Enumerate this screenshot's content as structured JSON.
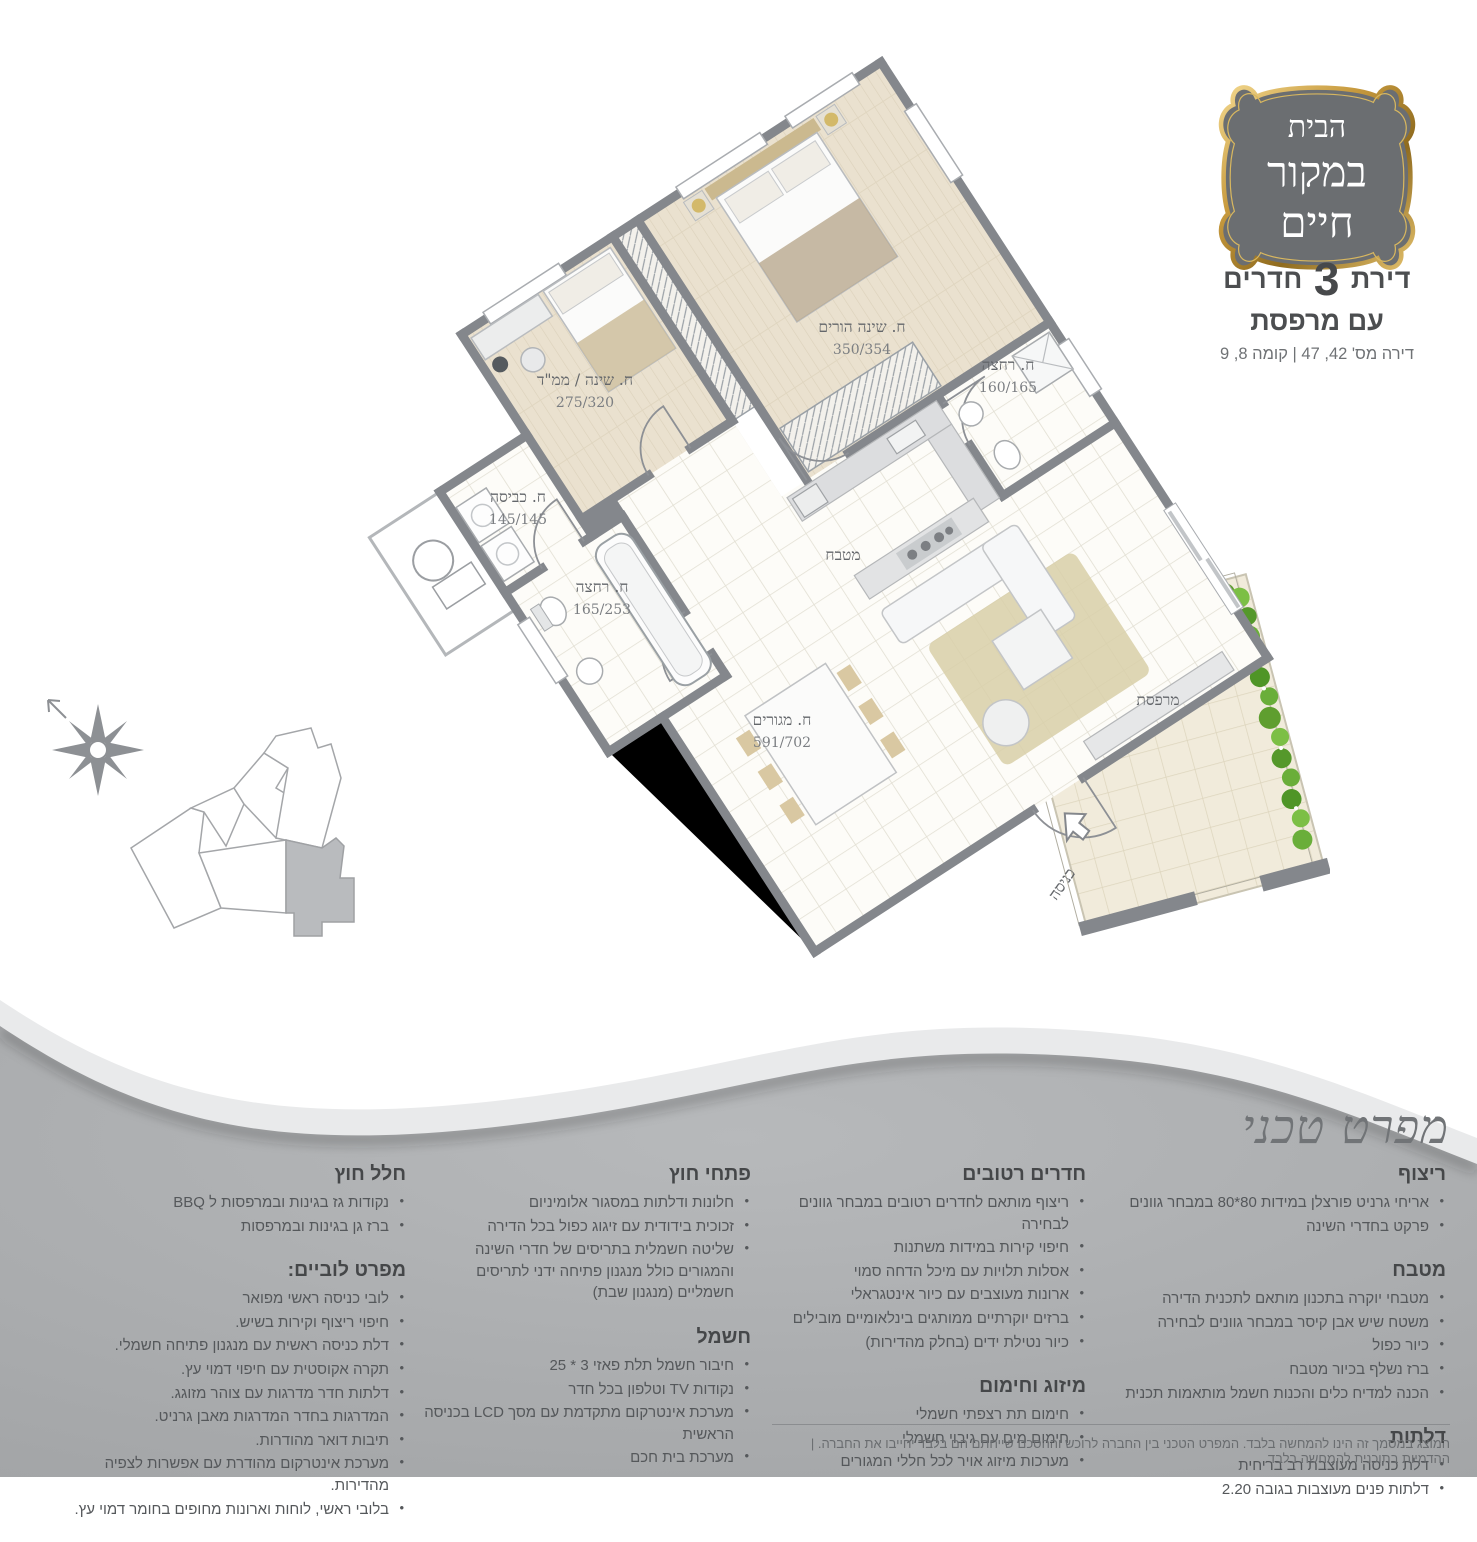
{
  "logo": {
    "line1": "הבית",
    "line2": "במקור",
    "line3": "חיים",
    "plaque_color": "#6b6e71",
    "gold_color": "#c89b3f"
  },
  "header": {
    "title_prefix": "דירת",
    "title_number": "3",
    "title_suffix": "חדרים",
    "subtitle": "עם מרפסת",
    "details": "דירה מס' 42, 47 | קומה 8, 9"
  },
  "floor_plan": {
    "rooms": [
      {
        "name": "ח. שינה / ממ\"ד",
        "dims": "275/320"
      },
      {
        "name": "ח. שינה הורים",
        "dims": "350/354"
      },
      {
        "name": "ח. רחצה",
        "dims": "160/165"
      },
      {
        "name": "ח. כביסה",
        "dims": "145/145"
      },
      {
        "name": "ח. רחצה",
        "dims": "165/253"
      },
      {
        "name": "ח. מגורים",
        "dims": "591/702"
      }
    ],
    "kitchen_label": "מטבח",
    "balcony_label": "מרפסת",
    "entrance_label": "כניסה",
    "wall_color": "#84878c",
    "wood_color": "#eae1cf",
    "balcony_tile_color": "#f1ebdb",
    "plant_color": "#6aae3a"
  },
  "spec": {
    "title": "מפרט טכני",
    "columns": [
      {
        "sections": [
          {
            "title": "ריצוף",
            "items": [
              "אריחי גרניט פורצלן במידות 80*80 במבחר גוונים",
              "פרקט בחדרי השינה"
            ]
          },
          {
            "title": "מטבח",
            "items": [
              "מטבחי יוקרה בתכנון מותאם לתכנית הדירה",
              "משטח שיש אבן קיסר במבחר גוונים לבחירה",
              "כיור כפול",
              "ברז נשלף בכיור מטבח",
              "הכנה למדיח כלים והכנות חשמל מותאמות תכנית"
            ]
          },
          {
            "title": "דלתות",
            "items": [
              "דלת כניסה מעוצבת רב בריחית",
              "דלתות פנים מעוצבות בגובה 2.20"
            ]
          }
        ]
      },
      {
        "sections": [
          {
            "title": "חדרים רטובים",
            "items": [
              "ריצוף מותאם לחדרים רטובים במבחר גוונים לבחירה",
              "חיפוי קירות במידות משתנות",
              "אסלות תלויות עם מיכל הדחה סמוי",
              "ארונות מעוצבים עם כיור אינטגראלי",
              "ברזים יוקרתיים ממותגים בינלאומיים מובילים",
              "כיור נטילת ידים (בחלק מהדירות)"
            ]
          },
          {
            "title": "מיזוג וחימום",
            "items": [
              "חימום תת רצפתי חשמלי",
              "חימום מים עם גיבוי חשמלי",
              "מערכות מיזוג אויר לכל חללי המגורים"
            ]
          }
        ]
      },
      {
        "sections": [
          {
            "title": "פתחי חוץ",
            "items": [
              "חלונות ודלתות במסגור אלומיניום",
              "זכוכית בידודית עם זיגוג כפול בכל הדירה",
              "שליטה חשמלית בתריסים של חדרי השינה והמגורים כולל מנגנון פתיחה ידני לתריסים חשמליים (מנגנון שבת)"
            ]
          },
          {
            "title": "חשמל",
            "items": [
              "חיבור חשמל תלת פאזי 3 * 25",
              "נקודות TV וטלפון בכל חדר",
              "מערכת אינטרקום מתקדמת עם מסך LCD בכניסה הראשית",
              "מערכת בית חכם"
            ]
          }
        ]
      },
      {
        "sections": [
          {
            "title": "חלל חוץ",
            "items": [
              "נקודות גז בגינות ובמרפסות ל BBQ",
              "ברז גן בגינות ובמרפסות"
            ]
          },
          {
            "title": "מפרט לוביים:",
            "items": [
              "לובי כניסה ראשי מפואר",
              "חיפוי ריצוף וקירות בשיש.",
              "דלת כניסה ראשית עם מנגנון פתיחה חשמלי.",
              "תקרה אקוסטית עם חיפוי דמוי עץ.",
              "דלתות חדר מדרגות עם צוהר מזוגג.",
              "המדרגות בחדר המדרגות מאבן גרניט.",
              "תיבות דואר מהודרות.",
              "מערכת אינטרקום מהודרת עם אפשרות לצפיה מהדירות.",
              "בלובי ראשי, לוחות וארונות מחופים בחומר דמוי עץ."
            ]
          }
        ]
      }
    ]
  },
  "footer": {
    "disclaimer": "המוצג במסמך זה הינו להמחשה בלבד. המפרט הטכני בין החברה לרוכש וההסכם שייחתם הם בלבד יחייבו את החברה. | ההדמיות בתוכנית להמחשה בלבד."
  }
}
